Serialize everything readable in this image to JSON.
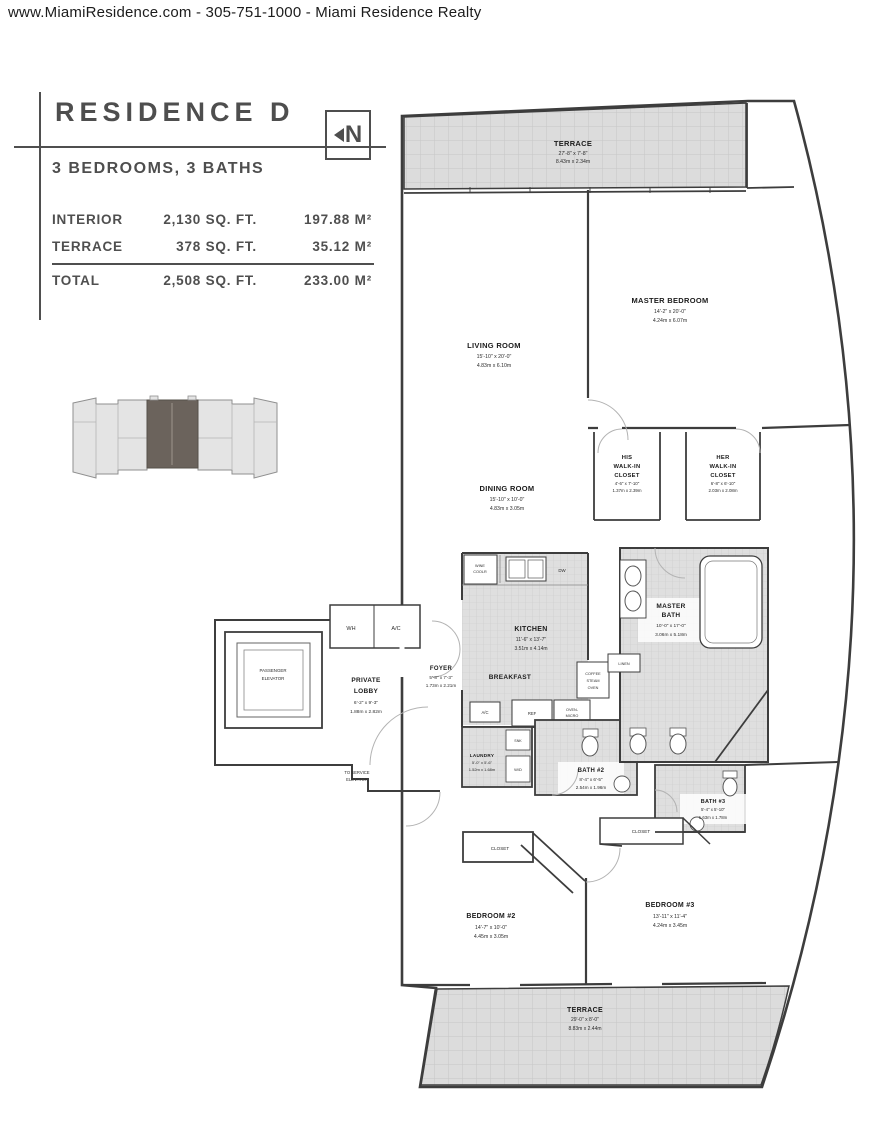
{
  "header": {
    "text": "www.MiamiResidence.com  -  305-751-1000  -  Miami Residence Realty"
  },
  "title_block": {
    "title": "RESIDENCE D",
    "north_label": "N",
    "subtitle": "3 BEDROOMS, 3 BATHS",
    "area_table": {
      "rows": [
        {
          "label": "INTERIOR",
          "sqft": "2,130 SQ. FT.",
          "sqm": "197.88 M²"
        },
        {
          "label": "TERRACE",
          "sqft": "378 SQ. FT.",
          "sqm": "35.12 M²"
        },
        {
          "label": "TOTAL",
          "sqft": "2,508 SQ. FT.",
          "sqm": "233.00 M²"
        }
      ]
    }
  },
  "colors": {
    "wall": "#3d3d3d",
    "terrace_fill": "#dcdcdc",
    "tile_fill": "#dfdfdf",
    "key_plan_highlight": "#6b635c",
    "title_text": "#4e4e4e"
  },
  "plan": {
    "rooms": {
      "terrace_top": {
        "name": "TERRACE",
        "ft": "27'-8\" x 7'-8\"",
        "m": "8.43m x 2.34m"
      },
      "living_room": {
        "name": "LIVING ROOM",
        "ft": "15'-10\" x 20'-0\"",
        "m": "4.83m x 6.10m"
      },
      "master_bedroom": {
        "name": "MASTER BEDROOM",
        "ft": "14'-2\" x 20'-0\"",
        "m": "4.24m x 6.07m"
      },
      "dining_room": {
        "name": "DINING ROOM",
        "ft": "15'-10\" x 10'-0\"",
        "m": "4.83m x 3.05m"
      },
      "his_closet": {
        "l1": "HIS",
        "l2": "WALK-IN",
        "l3": "CLOSET",
        "ft": "4'-6\" x 7'-10\"",
        "m": "1.37m x 2.39m"
      },
      "her_closet": {
        "l1": "HER",
        "l2": "WALK-IN",
        "l3": "CLOSET",
        "ft": "6'-8\" x 6'-10\"",
        "m": "2.03m x 2.08m"
      },
      "kitchen": {
        "name": "KITCHEN",
        "ft": "11'-6\" x 13'-7\"",
        "m": "3.51m x 4.14m"
      },
      "master_bath": {
        "l1": "MASTER",
        "l2": "BATH",
        "ft": "10'-0\" x 17'-0\"",
        "m": "3.06m x 5.18m"
      },
      "breakfast": {
        "name": "BREAKFAST"
      },
      "foyer": {
        "name": "FOYER",
        "ft": "5'-8\" x 7'-3\"",
        "m": "1.73m x 2.21m"
      },
      "private_lobby": {
        "l1": "PRIVATE",
        "l2": "LOBBY",
        "ft": "6'-2\" x 9'-3\"",
        "m": "1.88m x 2.82m"
      },
      "laundry": {
        "name": "LAUNDRY",
        "ft": "5'-0\" x 5'-6\"",
        "m": "1.52m x 1.68m"
      },
      "bath2": {
        "name": "BATH #2",
        "ft": "8'-4\" x 6'-5\"",
        "m": "2.54m x 1.96m"
      },
      "bath3": {
        "name": "BATH #3",
        "ft": "5'-4\" x 5'-10\"",
        "m": "1.63m x 1.78m"
      },
      "bedroom2": {
        "name": "BEDROOM #2",
        "ft": "14'-7\" x 10'-0\"",
        "m": "4.45m x 3.05m"
      },
      "bedroom3": {
        "name": "BEDROOM #3",
        "ft": "13'-11\" x 11'-4\"",
        "m": "4.24m x 3.45m"
      },
      "terrace_bottom": {
        "name": "TERRACE",
        "ft": "29'-0\" x 8'-0\"",
        "m": "8.83m x 2.44m"
      }
    },
    "fixtures": {
      "wh": "WH",
      "ac": "A/C",
      "ac_small": "A/C",
      "wine1": "WINE",
      "wine2": "COOLR",
      "dw": "DW",
      "ref": "REF",
      "oven1": "OVEN-",
      "oven2": "MICRO",
      "snk": "SNK",
      "wd": "W/D",
      "linen": "LINEN",
      "coffee1": "COFFEE",
      "coffee2": "STEAM",
      "coffee3": "OVEN",
      "closet": "CLOSET",
      "elev1": "PASSENGER",
      "elev2": "ELEVATOR",
      "service1": "TO SERVICE",
      "service2": "ELEVATOR"
    }
  }
}
